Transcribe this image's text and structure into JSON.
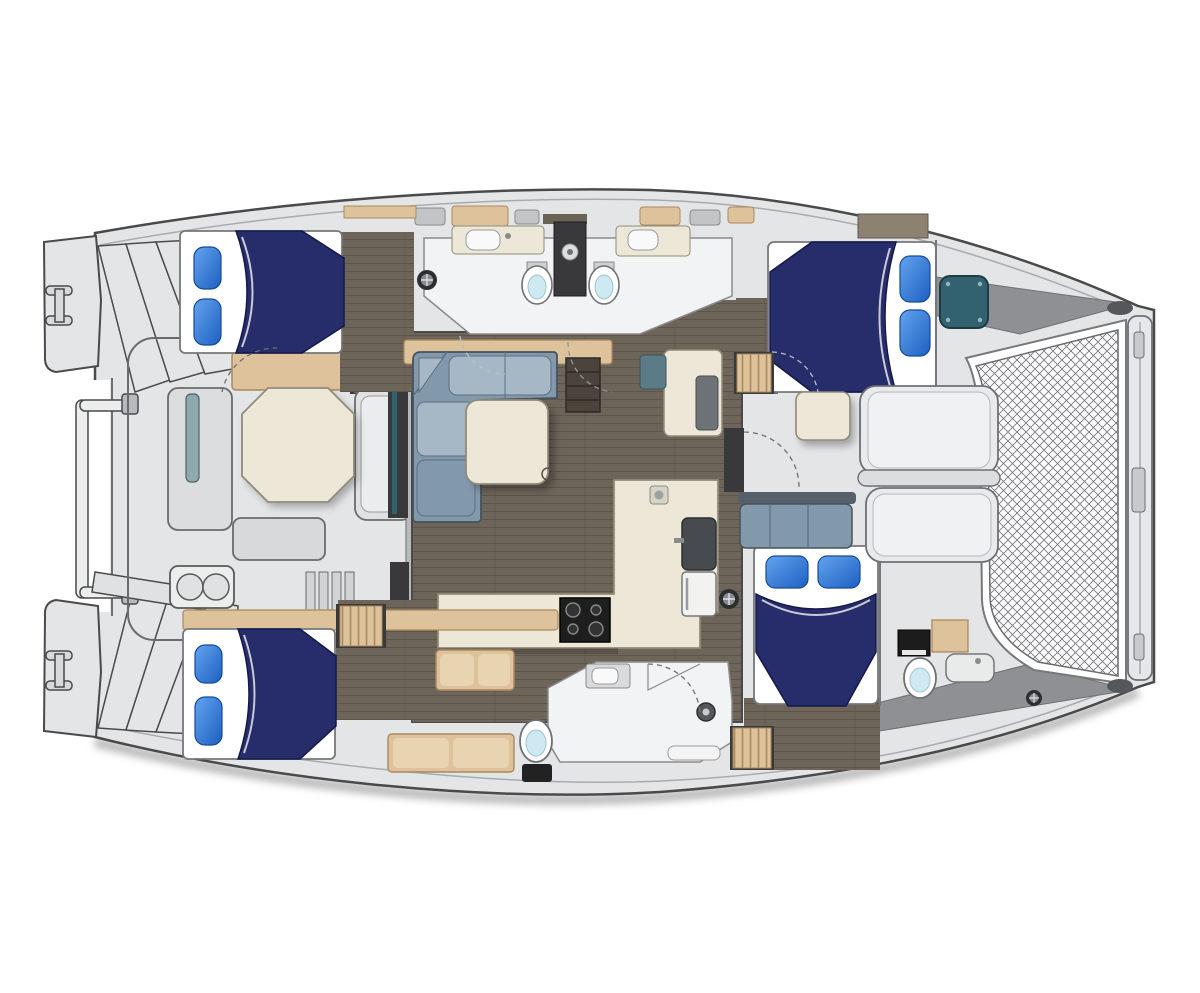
{
  "diagram": {
    "type": "yacht-floorplan",
    "vessel": "sailing-catamaran",
    "view": "top-down interior layout plan",
    "cabins": 4,
    "double_berths": 4,
    "pillows_per_berth": 2,
    "toilets": 4,
    "showers": 2,
    "features": [
      "bow-trampoline-net",
      "bow-crossbeam",
      "forward-cockpit-lounge",
      "saloon-l-sofa",
      "saloon-table",
      "nav-station",
      "galley-stove",
      "galley-sink",
      "fridge",
      "dinette-bench",
      "port-aft-cabin-bed",
      "port-forward-cabin-bed",
      "starboard-aft-cabin-bed",
      "starboard-forward-cabin-bed",
      "twin-heads-port",
      "starboard-mid-head",
      "starboard-forward-head",
      "aft-cockpit-table",
      "aft-cockpit-bench",
      "stern-rail",
      "transom-steps",
      "mooring-cleats",
      "companionway-steps",
      "deck-hatches",
      "sliding-door"
    ]
  },
  "colors": {
    "deck": "#e4e5e7",
    "deckShade": "#cfd0d3",
    "hullOutline": "#4a4a4c",
    "innerLine": "#a9abae",
    "interiorFloor": "#6e655a",
    "floorLine": "#5d544a",
    "woodTrim": "#dec29c",
    "woodDark": "#a98a5d",
    "counter": "#ece7d6",
    "counterEdge": "#918c79",
    "duvetNavy": "#272c6a",
    "duvetEdge": "#14194a",
    "pillowBlue": "#2f7bd6",
    "sofaBlue": "#8299ac",
    "sofaBlueLight": "#a6b8c6",
    "sofaEdge": "#46525c",
    "tealGlass": "#32616f",
    "charcoal": "#39393b",
    "bathFloor": "#f2f3f4",
    "bathEdge": "#8a8b8d",
    "toiletWater": "#cfe9f2",
    "meshLine": "#73747a",
    "grayWedge": "#8e9093",
    "white": "#ffffff"
  }
}
